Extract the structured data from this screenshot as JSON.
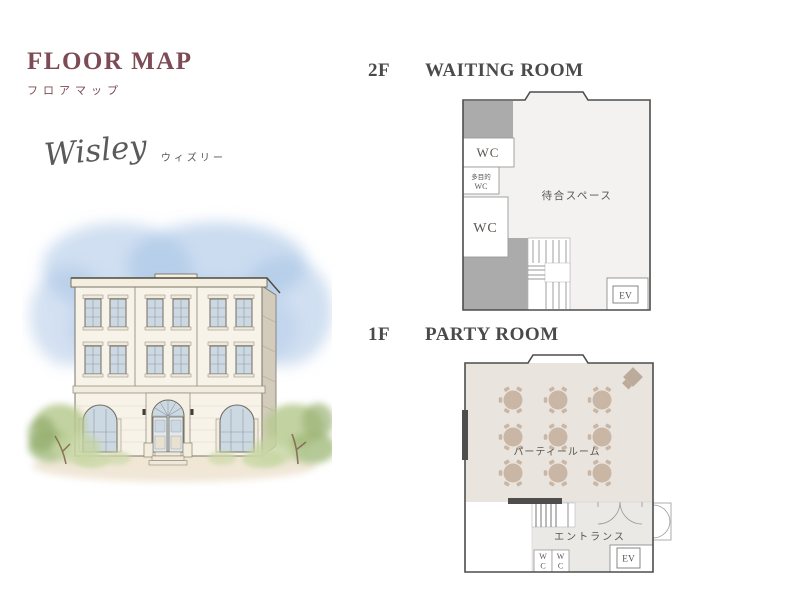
{
  "page": {
    "title": "FLOOR MAP",
    "subtitle": "フロアマップ"
  },
  "brand": {
    "script": "Wisley",
    "kana": "ウィズリー"
  },
  "floors": {
    "f2": {
      "level": "2F",
      "name": "WAITING ROOM",
      "labels": {
        "wc_top": "WC",
        "multi_wc_1": "多目的",
        "multi_wc_2": "WC",
        "wc_bottom": "WC",
        "waiting_space": "待合スペース",
        "elevator": "EV"
      }
    },
    "f1": {
      "level": "1F",
      "name": "PARTY ROOM",
      "labels": {
        "party_room": "パーティールーム",
        "entrance": "エントランス",
        "wc_w": "W",
        "wc_c": "C",
        "elevator": "EV"
      }
    }
  },
  "colors": {
    "accent_maroon": "#7c4b55",
    "heading_gray": "#4a4a4a",
    "plan_border": "#4d4d4d",
    "plan_fill_2f": "#f3f2f1",
    "gray_block": "#ababab",
    "party_room_fill": "#e9e5de",
    "table_tan": "#c9b6a5",
    "entrance_fill": "#ebe9e5",
    "dark_fixture": "#4e4e4e",
    "sky_blue": "#a9c4e6",
    "foliage_green": "#b7ca90",
    "building_cream": "#f8f3e9"
  }
}
